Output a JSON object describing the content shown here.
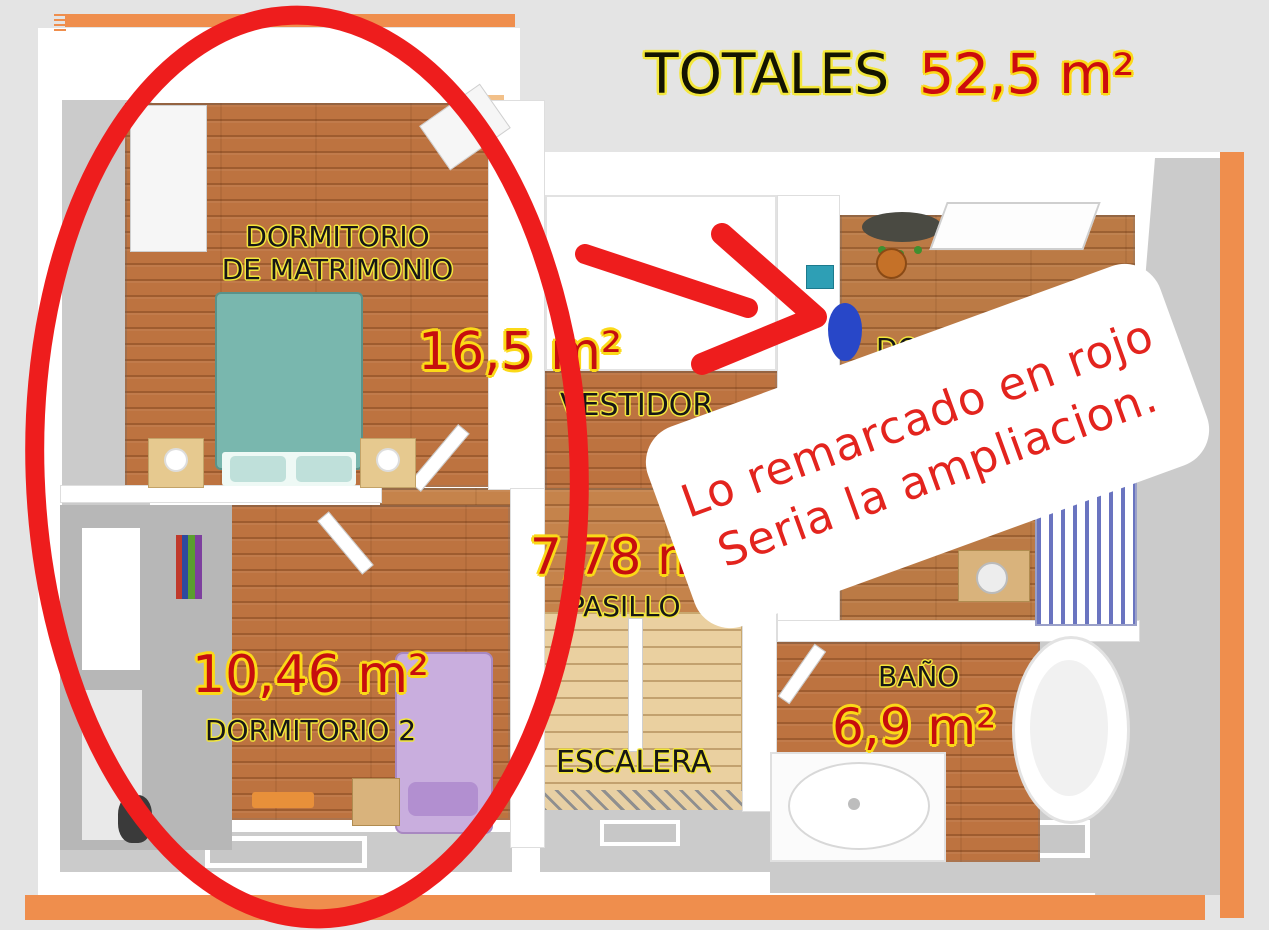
{
  "header": {
    "totals_label": "TOTALES",
    "totals_value": "52,5 m²"
  },
  "rooms": {
    "master": {
      "label_line1": "DORMITORIO",
      "label_line2": "DE MATRIMONIO",
      "area": "16,5 m²"
    },
    "vestidor": {
      "label": "VESTIDOR"
    },
    "pasillo": {
      "label": "PASILLO",
      "area": "7,78 m²"
    },
    "escalera": {
      "label": "ESCALERA"
    },
    "dorm2": {
      "label": "DORMITORIO 2",
      "area": "10,46 m²"
    },
    "bano": {
      "label": "BAÑO",
      "area": "6,9 m²"
    },
    "dorm3": {
      "label_visible": "DORMI"
    }
  },
  "annotation": {
    "line1": "Lo remarcado en rojo",
    "line2": "Seria la ampliacion."
  },
  "colors": {
    "background": "#e4e4e4",
    "roof_accent_orange": "#ef8e4d",
    "wood_floor": "#bd7340",
    "stairs_wood": "#ead0a0",
    "area_text_red": "#c60e0e",
    "label_outline_yellow": "#f3e73c",
    "marker_red": "#ee1d1d",
    "annotation_text_red": "#e3241e",
    "master_bed_teal": "#79b7ae",
    "dorm2_bed_purple": "#c9aede"
  }
}
